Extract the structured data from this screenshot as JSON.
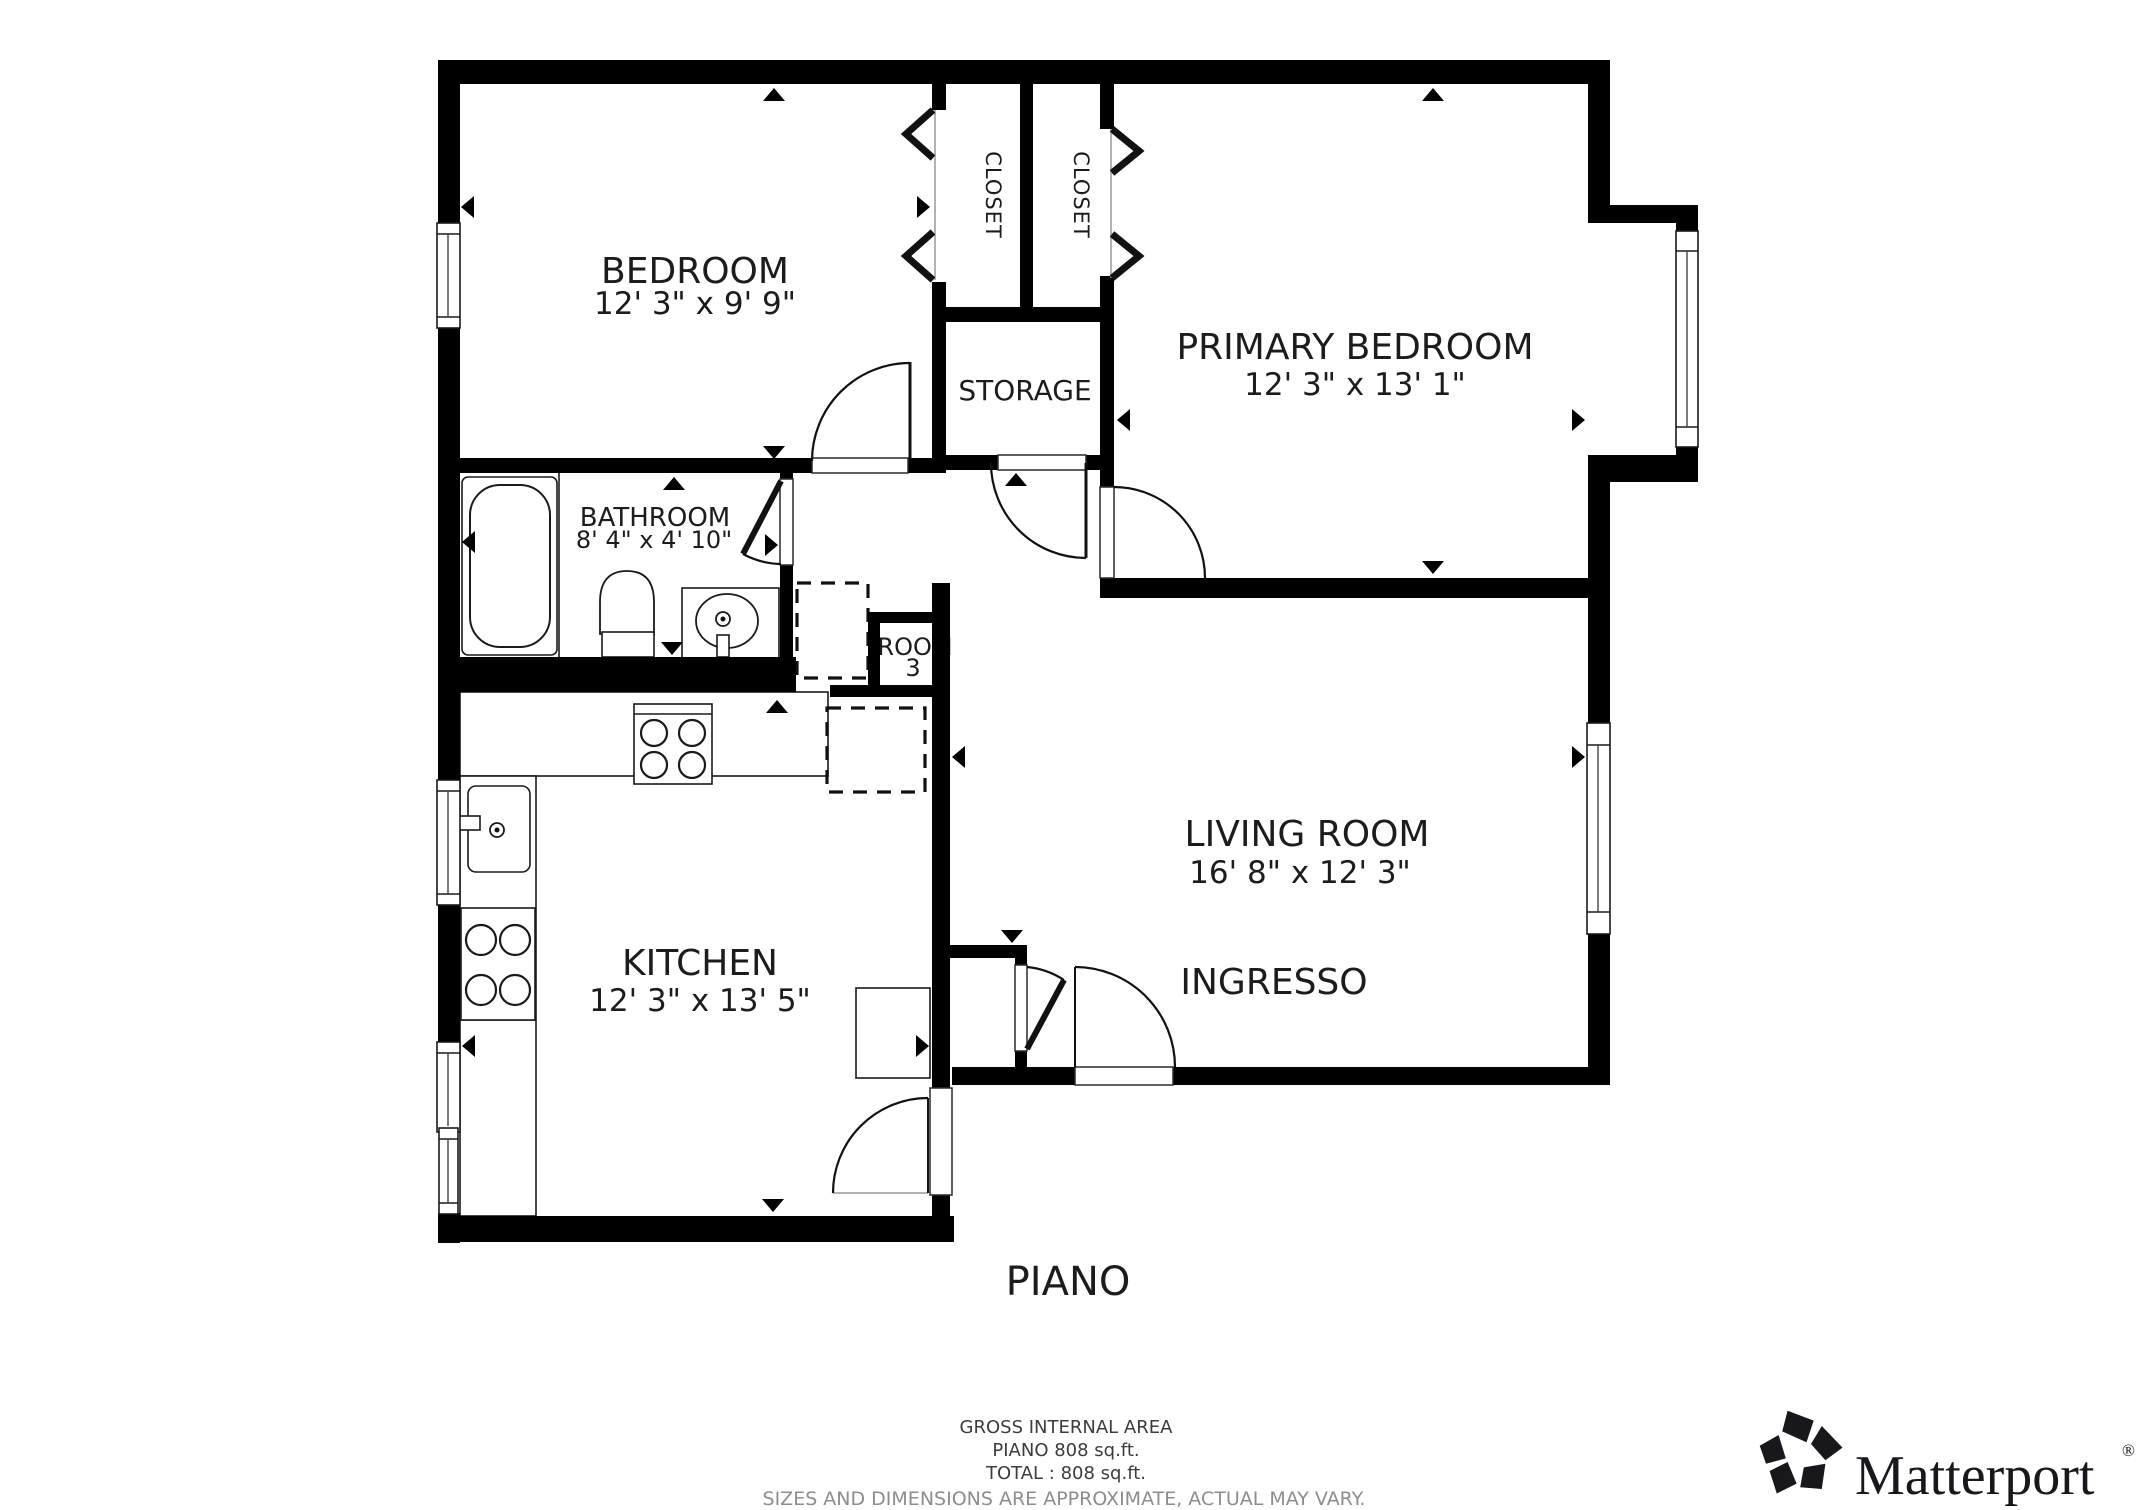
{
  "page": {
    "background": "#ffffff"
  },
  "plan": {
    "floor_label": "PIANO",
    "rooms": {
      "bedroom": {
        "name": "BEDROOM",
        "dims": "12' 3\" x 9' 9\""
      },
      "closet_left": {
        "name": "CLOSET"
      },
      "closet_right": {
        "name": "CLOSET"
      },
      "primary_bedroom": {
        "name": "PRIMARY BEDROOM",
        "dims": "12' 3\" x 13' 1\""
      },
      "storage": {
        "name": "STORAGE"
      },
      "bathroom": {
        "name": "BATHROOM",
        "dims": "8' 4\" x 4' 10\""
      },
      "room3": {
        "name": "ROOM",
        "number": "3"
      },
      "kitchen": {
        "name": "KITCHEN",
        "dims": "12' 3\" x 13' 5\""
      },
      "living_room": {
        "name": "LIVING ROOM",
        "dims": "16' 8\" x 12' 3\""
      },
      "ingresso": {
        "name": "INGRESSO"
      }
    }
  },
  "footer": {
    "line1": "GROSS INTERNAL AREA",
    "line2": "PIANO 808 sq.ft.",
    "line3": "TOTAL :  808 sq.ft.",
    "line4": "SIZES AND DIMENSIONS ARE APPROXIMATE, ACTUAL MAY VARY."
  },
  "branding": {
    "logo_text": "Matterport",
    "registered": "®"
  },
  "colors": {
    "wall": "#000000",
    "background": "#ffffff",
    "footer_text": "#3c3c3c",
    "footer_muted": "#8d8d8d"
  }
}
